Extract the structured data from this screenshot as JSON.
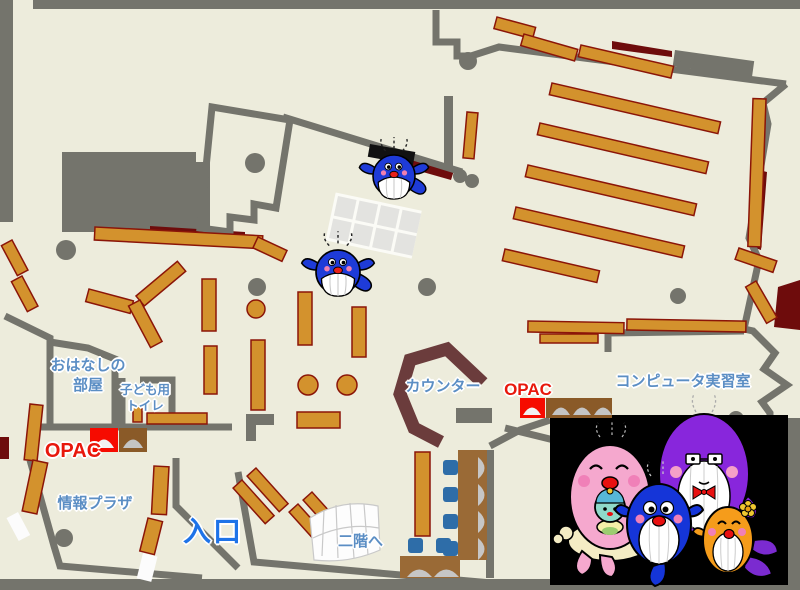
{
  "labels": {
    "storytelling_room": "おはなしの\n部屋",
    "kids_toilet": "子ども用\nトイレ",
    "opac_children": "OPAC",
    "info_plaza": "情報プラザ",
    "entrance": "入口",
    "counter": "カウンター",
    "opac_main": "OPAC",
    "computer_room": "コンピュータ実習室",
    "to_second_floor": "二階へ"
  },
  "icons": {
    "map_whale_1": "blue-whale-mascot",
    "map_whale_2": "blue-whale-mascot",
    "mascot_panel": "whale-family-illustration"
  },
  "colors": {
    "floor": "#EDECDC",
    "wall_gray": "#74746C",
    "shelf_orange": "#D3922D",
    "shelf_border": "#8B1508",
    "dark_red": "#6E0C0C",
    "counter_maroon": "#6B3C3C",
    "label_blue": "#5B8EC4",
    "entrance_blue": "#1E73E8",
    "opac_red": "#E8180C",
    "chair_blue": "#2E6DA8",
    "desk_brown": "#9A6A36",
    "panel_black": "#000000",
    "whale_blue": "#1E3BD8",
    "mascot_pink": "#F5A8CE",
    "mascot_purple": "#8826DC",
    "mascot_orange": "#F59C1B"
  }
}
